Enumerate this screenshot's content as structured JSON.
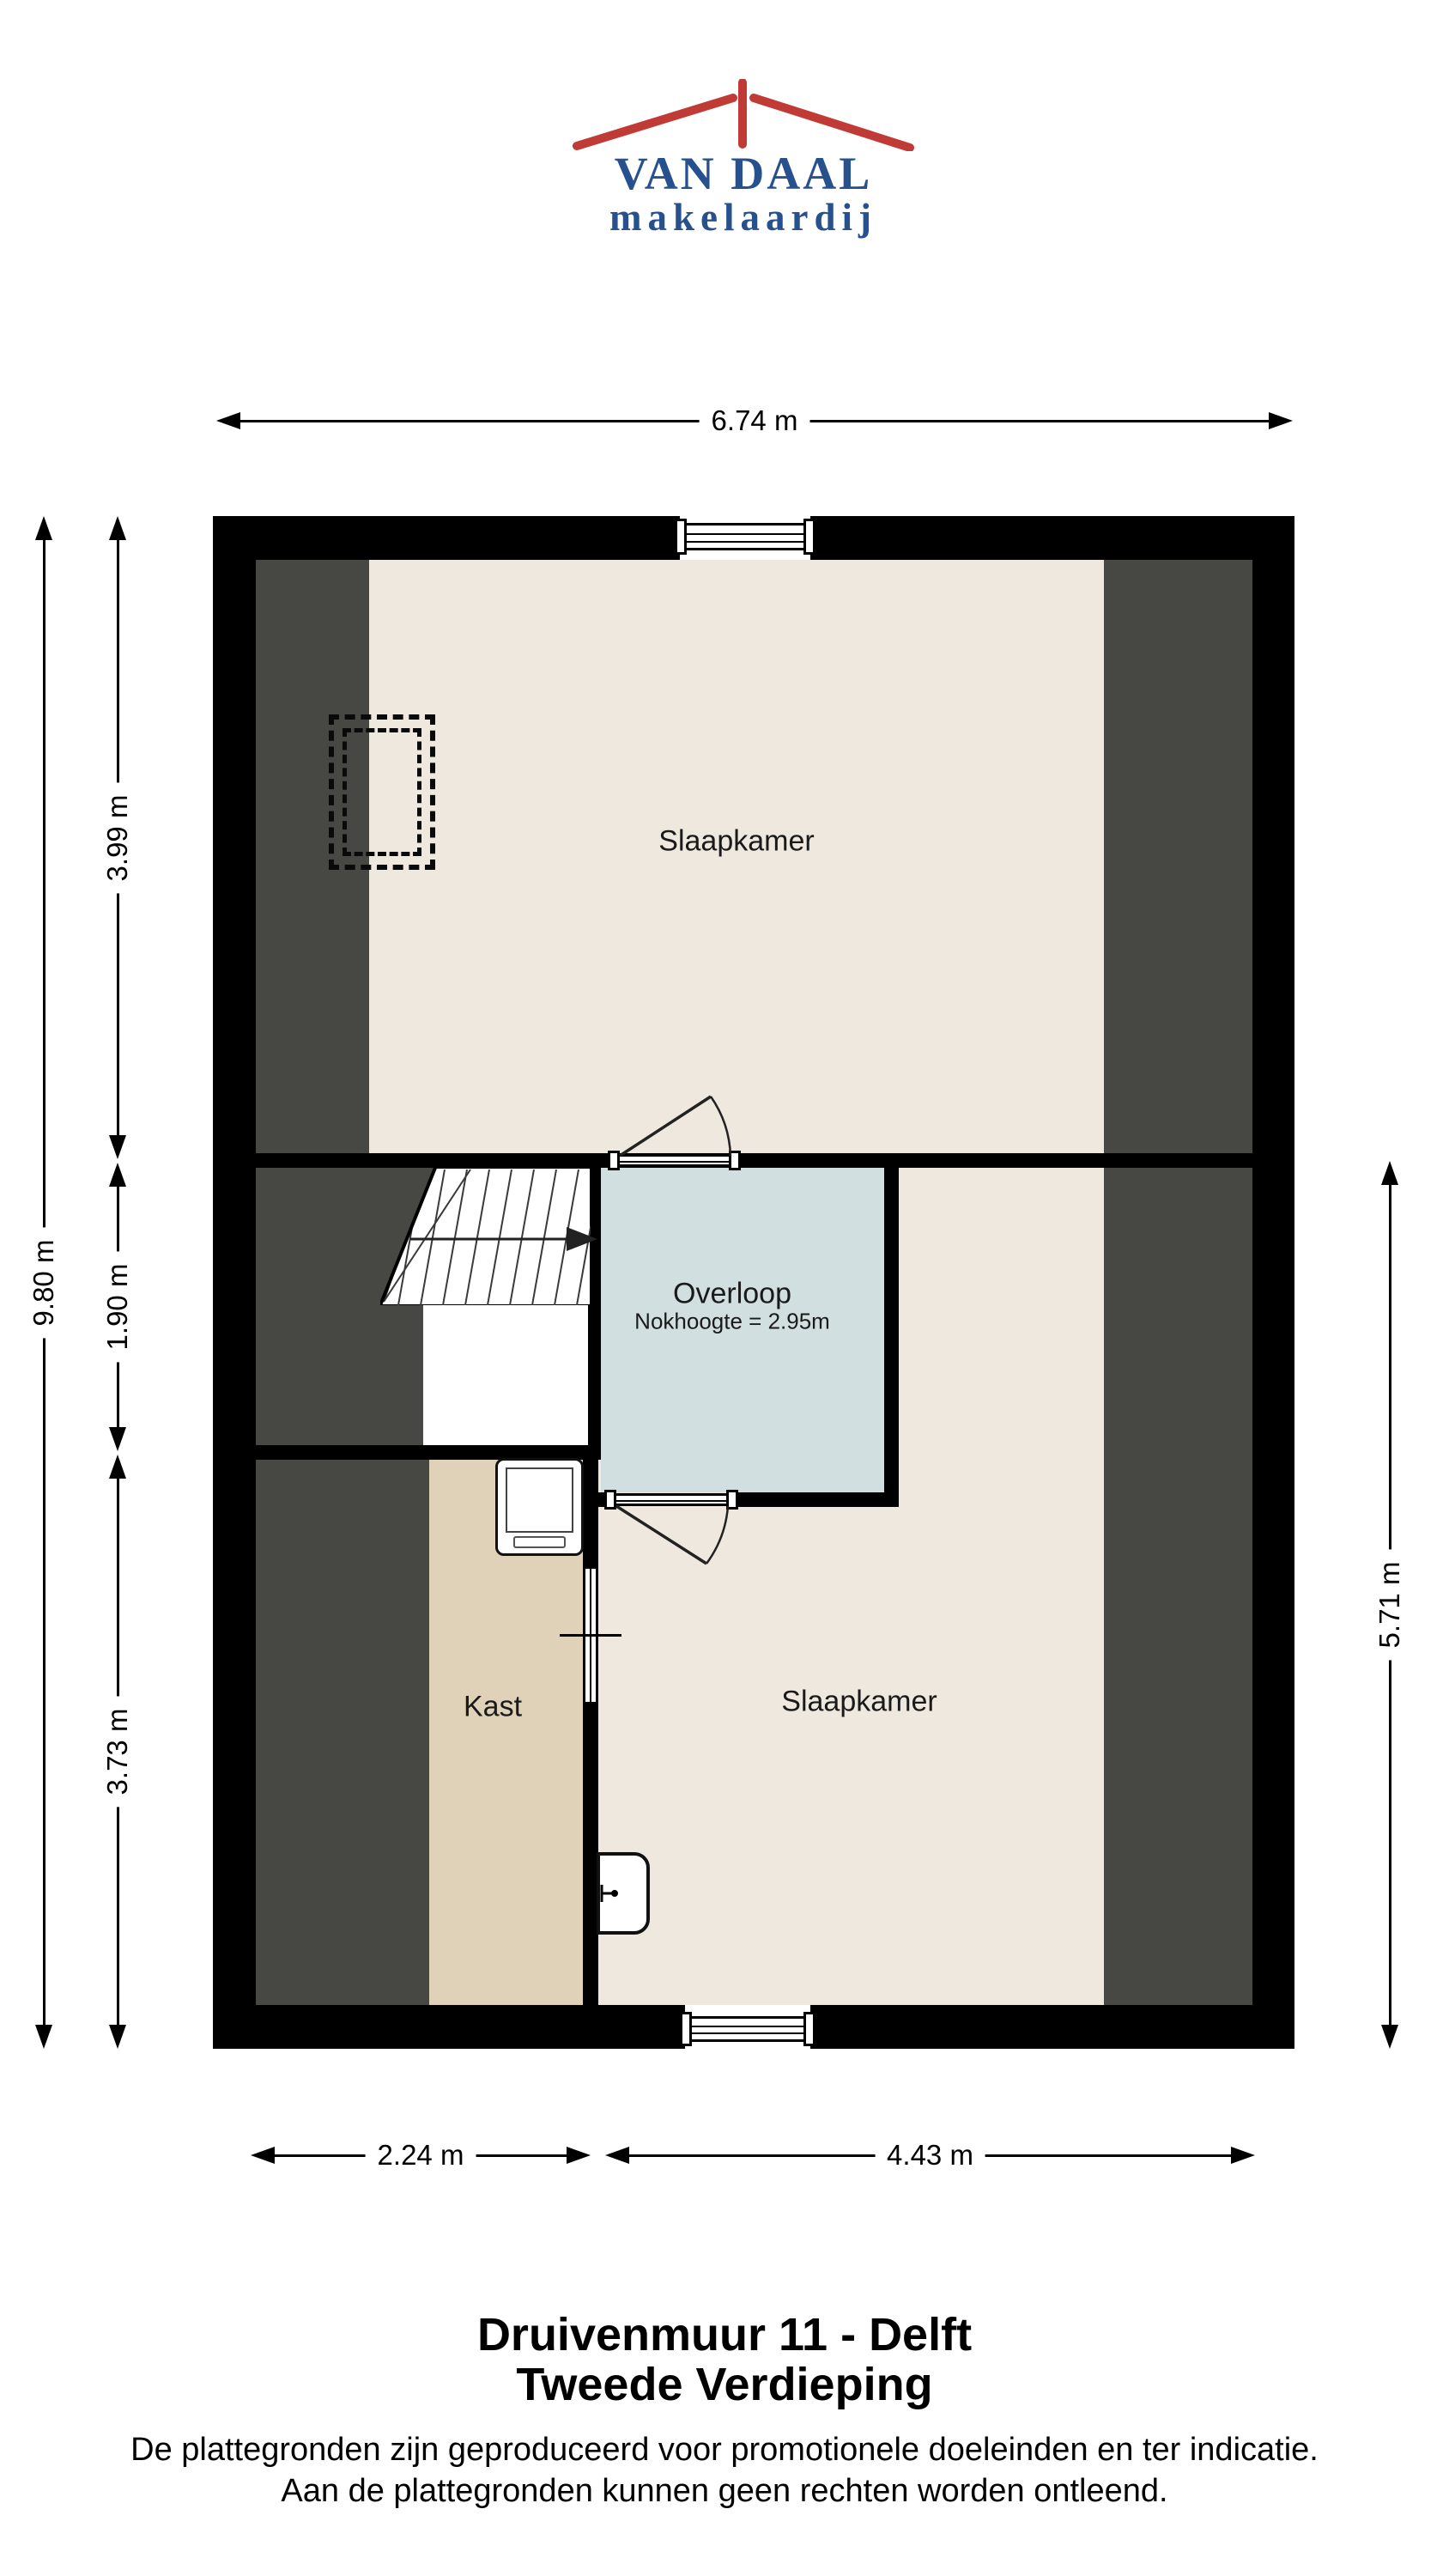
{
  "logo": {
    "name": "VAN DAAL",
    "tagline": "makelaardij"
  },
  "plan": {
    "rooms": [
      {
        "id": "slaapkamer-top",
        "label": "Slaapkamer"
      },
      {
        "id": "overloop",
        "label": "Overloop",
        "sub": "Nokhoogte = 2.95m"
      },
      {
        "id": "kast",
        "label": "Kast"
      },
      {
        "id": "slaapkamer-bottom",
        "label": "Slaapkamer"
      }
    ]
  },
  "dimensions": {
    "top": "6.74 m",
    "left_total": "9.80 m",
    "left_segments": [
      "3.99 m",
      "1.90 m",
      "3.73 m"
    ],
    "right": "5.71 m",
    "bottom_left": "2.24 m",
    "bottom_right": "4.43 m"
  },
  "footer": {
    "title_line1": "Druivenmuur 11 - Delft",
    "title_line2": "Tweede Verdieping",
    "disclaimer_line1": "De plattegronden zijn geproduceerd voor promotionele doeleinden en ter indicatie.",
    "disclaimer_line2": "Aan de plattegronden kunnen geen rechten worden ontleend."
  },
  "colors": {
    "logo_blue": "#27508F",
    "logo_red": "#C13B36",
    "wall_black": "#000000",
    "room_cream": "#EFE8DE",
    "closet_tan": "#DFD2B8",
    "landing_blue": "#D2DFE0",
    "attic_gray": "#474744"
  }
}
